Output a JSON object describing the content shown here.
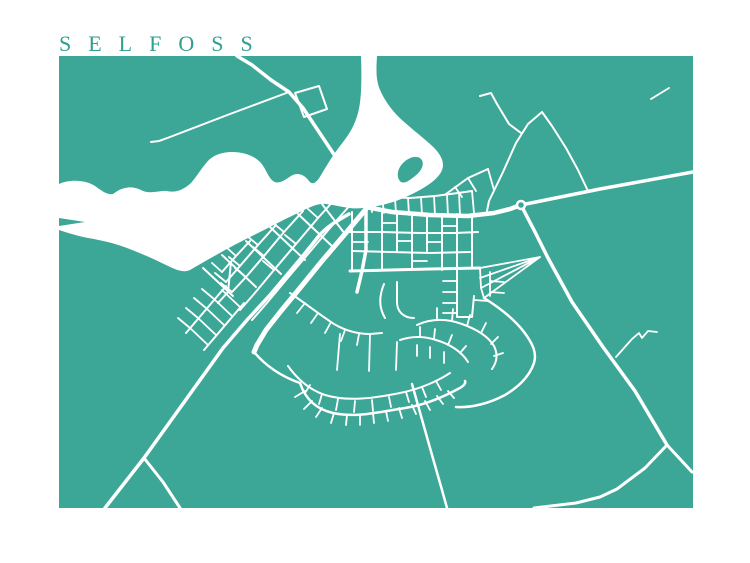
{
  "title": {
    "text": "SELFOSS"
  },
  "colors": {
    "page_bg": "#ffffff",
    "land": "#3CA796",
    "water": "#ffffff",
    "road": "#ffffff",
    "title": "#2F9F8E"
  },
  "map": {
    "frame": {
      "x": 59,
      "y": 56,
      "width": 634,
      "height": 452
    },
    "water": [
      "M59,184 C70,179 86,180 95,186 C102,191 107,195 113,194 C123,186 133,186 141,190 C150,195 159,190 167,191 C176,193 183,190 191,183 C197,176 201,169 207,162 C213,155 222,152 232,152 C244,152 255,156 261,163 C266,169 268,177 273,181 C278,185 285,180 291,176 C297,172 304,174 309,181 C313,186 317,182 321,175 C327,165 333,155 340,146 C347,137 354,128 358,113 C361,102 362,85 361,56 L377,56 C376,72 376,82 381,92 C386,103 394,113 403,121 C412,129 421,136 430,144 C438,151 443,158 443,165 C443,172 437,179 428,185 C419,191 407,197 396,201 C387,204 378,206 372,207 C364,208 357,209 350,208 C342,207 334,205 326,204 C318,203 310,207 300,212 C287,218 272,226 258,233 C244,240 230,247 218,254 C207,260 197,266 190,270 C184,273 176,270 166,265 C154,259 140,253 127,248 C114,243 100,240 88,238 C78,236 68,233 59,230 L59,226 L85,222 L59,218 Z"
    ],
    "islands": [
      "M428,121 C424,118 424,111 428,106 C432,101 438,100 441,104 C444,108 442,115 437,119 C434,122 431,123 428,121 Z",
      "M401,182 C396,178 397,169 403,163 C409,157 417,155 421,159 C425,163 422,171 415,176 C410,180 405,184 401,182 Z"
    ],
    "roundabout": {
      "cx": 521,
      "cy": 205,
      "r": 4
    },
    "roads": [
      {
        "d": "M237,56 L252,65 L271,80 L289,92 L303,108 L319,132 L335,156 L349,178 L359,195 L366,207",
        "w": 3.5
      },
      {
        "d": "M295,93 L319,86 L327,109 L304,117 Z",
        "w": 2
      },
      {
        "d": "M289,92 L230,114 L170,137 L159,141 L151,142",
        "w": 2
      },
      {
        "d": "M348,166 C336,168 331,176 334,184 C337,191 347,194 354,189",
        "w": 2
      },
      {
        "d": "M366,207 L392,212 L430,215 L468,216 L494,213 L510,209 L521,205",
        "w": 4.5
      },
      {
        "d": "M521,205 L600,189 L693,172",
        "w": 3.5
      },
      {
        "d": "M521,205 L535,232 L548,258 L572,302 L603,347 L635,391 L667,445",
        "w": 3.5
      },
      {
        "d": "M667,445 L680,459 L692,472",
        "w": 3
      },
      {
        "d": "M667,445 L645,468 L617,489 L600,497 L576,503 L534,508",
        "w": 3
      },
      {
        "d": "M616,357 L632,339 L639,333 L642,338 L648,331 L657,332",
        "w": 1.8
      },
      {
        "d": "M487,211 L489,201 L503,172 L516,143 L528,124 L542,112 L552,126 L566,148 L578,170 L588,191",
        "w": 2
      },
      {
        "d": "M480,96 L491,93 L497,104 L509,124 L521,133",
        "w": 2
      },
      {
        "d": "M651,99 L669,88",
        "w": 1.8
      },
      {
        "d": "M366,209 L345,234 L322,261 L300,288 L281,311 L266,330 L257,345 L254,352",
        "w": 5
      },
      {
        "d": "M349,214 C335,222 325,228 318,237 L302,257 L270,295 L247,320 L223,348 L195,387 L144,458 L105,508",
        "w": 3.5
      },
      {
        "d": "M144,458 L163,482 L180,508",
        "w": 3
      },
      {
        "d": "M352,203 L330,228 L308,254 L286,280 L266,304 L252,320",
        "w": 2
      },
      {
        "d": "M337,197 L318,218 L296,244 L274,270 L254,294 L240,310",
        "w": 2
      },
      {
        "d": "M303,211 L284,232 L264,256 L246,277 L232,292",
        "w": 2
      },
      {
        "d": "M276,225 L258,245 L240,266 L226,282",
        "w": 2
      },
      {
        "d": "M250,241 L236,256 L222,272",
        "w": 2
      },
      {
        "d": "M322,204 L345,234",
        "w": 2
      },
      {
        "d": "M298,214 L333,247",
        "w": 2
      },
      {
        "d": "M270,227 L305,260",
        "w": 2
      },
      {
        "d": "M246,241 L281,274",
        "w": 2
      },
      {
        "d": "M222,255 L256,287",
        "w": 2
      },
      {
        "d": "M203,268 L233,296",
        "w": 2
      },
      {
        "d": "M318,218 L308,209 M296,244 L285,235 M274,270 L263,261 M284,232 L273,223 M264,256 L253,247 M246,277 L235,268 M258,245 L247,236 M240,266 L229,257 M236,256 L226,247 M222,272 L212,263 M226,282 L215,273 M232,292 L221,283",
        "w": 1.8
      },
      {
        "d": "M231,262 L228,292 L218,303",
        "w": 2
      },
      {
        "d": "M186,333 L226,286",
        "w": 2
      },
      {
        "d": "M204,350 L244,303",
        "w": 2
      },
      {
        "d": "M190,328 L208,345 M198,318 L216,335 M206,308 L224,325 M214,299 L232,316 M222,290 L240,307 M190,328 L178,318 M198,318 L186,308 M206,308 L194,298 M214,299 L202,289",
        "w": 1.8
      },
      {
        "d": "M363,202 L385,197 L410,198 L435,196 L458,193 L472,191",
        "w": 2
      },
      {
        "d": "M370,198 L372,212 M382,197 L384,213 M395,198 L396,214 M408,198 L409,215 M421,197 L422,215 M434,196 L435,215 M447,195 L448,216 M459,193 L460,215 M472,191 L474,213",
        "w": 1.8
      },
      {
        "d": "M446,194 L468,178 L488,169",
        "w": 2
      },
      {
        "d": "M468,178 L476,191 M455,187 L462,197 M488,169 L494,190",
        "w": 1.8
      },
      {
        "d": "M350,232 L380,232 L420,233 L455,233 L478,232",
        "w": 2
      },
      {
        "d": "M352,251 L390,252 L430,253 L470,252",
        "w": 2
      },
      {
        "d": "M350,271 L390,270 L430,269 L480,268",
        "w": 3
      },
      {
        "d": "M366,208 L366,250 L362,271 L357,292",
        "w": 3.5
      },
      {
        "d": "M352,212 L352,270 M382,212 L382,270 M397,213 L397,251 M412,213 L412,270 M427,214 L427,251 M442,214 L442,270 M457,214 L457,268 M472,214 L472,268",
        "w": 2
      },
      {
        "d": "M397,241 L412,241 M427,242 L442,242 M442,226 L457,226 M382,223 L397,223 M412,261 L427,261 M352,242 L368,242",
        "w": 1.8
      },
      {
        "d": "M457,270 L457,317 L472,317 L474,296",
        "w": 2
      },
      {
        "d": "M457,281 L443,281 M457,292 L443,292 M457,303 L443,303 M457,313 L443,313 M474,300 L488,301 M490,272 L490,296 M490,281 L504,282 M490,292 L504,293",
        "w": 1.8
      },
      {
        "d": "M540,257 L480,268 M540,257 L480,278 M540,257 L481,288 M540,257 L484,298 M480,268 L481,288 L484,298",
        "w": 1.8
      },
      {
        "d": "M484,298 C500,308 515,320 524,332 C533,344 537,353 534,363 C530,375 520,386 505,395 C490,403 472,408 456,407",
        "w": 2.5
      },
      {
        "d": "M417,325 C432,318 448,319 462,324 C476,329 488,336 494,346 C498,354 497,362 492,369",
        "w": 2
      },
      {
        "d": "M437,320 L437,308 M452,321 L453,309 M467,326 L470,315 M481,333 L486,323 M491,344 L498,337 M494,356 L503,353",
        "w": 1.8
      },
      {
        "d": "M400,340 C412,336 424,336 436,340 C450,344 462,352 468,362",
        "w": 2
      },
      {
        "d": "M420,337 L420,327 M434,339 L435,329 M448,345 L452,335 M460,353 L466,346 M417,345 L417,356 M430,347 L430,358 M444,352 L444,363",
        "w": 1.8
      },
      {
        "d": "M384,284 C379,296 379,308 385,318 M397,282 L397,302 C397,312 404,318 414,318",
        "w": 2
      },
      {
        "d": "M290,293 C305,303 320,315 334,324 C346,331 358,334 370,334 L382,333",
        "w": 2
      },
      {
        "d": "M305,303 L297,313 M318,313 L311,323 M331,322 L325,333 M345,330 L341,341 M359,334 L357,345",
        "w": 1.8
      },
      {
        "d": "M300,383 C305,398 315,409 333,413 C355,418 380,412 405,408 C425,405 445,396 458,389 C464,386 466,383 465,381",
        "w": 2.5
      },
      {
        "d": "M305,391 L295,397 M312,401 L304,409 M322,408 L316,417 M334,413 L331,423 M347,415 L346,425 M360,415 L360,425 M373,413 L374,423 M386,411 L388,421 M399,408 L402,418 M412,405 L416,414 M425,401 L430,410 M437,396 L443,404 M448,391 L454,398",
        "w": 1.8
      },
      {
        "d": "M288,366 C298,380 310,390 325,395 C348,402 375,398 400,393 C420,389 438,381 450,373",
        "w": 2
      },
      {
        "d": "M310,385 L305,393 M322,394 L319,404 M338,399 L336,410 M355,401 L354,412 M372,400 L373,411 M389,397 L391,407 M406,392 L409,402 M422,387 L426,397 M436,381 L441,390",
        "w": 1.8
      },
      {
        "d": "M340,334 L337,370 M370,335 L369,371 M397,342 L396,370",
        "w": 1.8
      },
      {
        "d": "M412,384 L432,455 L442,490 L447,508",
        "w": 2.5
      },
      {
        "d": "M254,352 C265,365 280,376 300,383",
        "w": 2.5
      }
    ]
  }
}
